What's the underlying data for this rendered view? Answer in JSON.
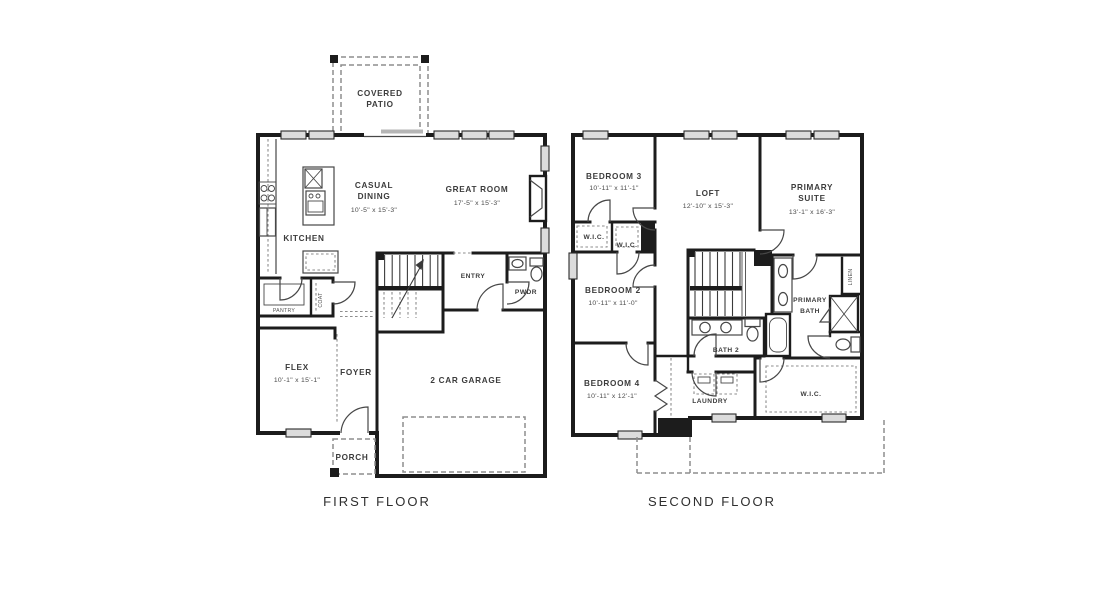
{
  "colors": {
    "wall": "#1c1c1c",
    "fixture": "#474747",
    "dash": "#8d8d8d",
    "winfill": "#dcdcdc",
    "text": "#3c3c3c",
    "bg": "#ffffff"
  },
  "floors": {
    "first": {
      "title": "FIRST FLOOR",
      "rooms": {
        "covered_patio": {
          "line1": "COVERED",
          "line2": "PATIO"
        },
        "casual_dining": {
          "line1": "CASUAL",
          "line2": "DINING",
          "dims": "10'-5\" x 15'-3\""
        },
        "great_room": {
          "name": "GREAT ROOM",
          "dims": "17'-5\" x 15'-3\""
        },
        "kitchen": {
          "name": "KITCHEN"
        },
        "pantry": {
          "name": "PANTRY"
        },
        "coat": {
          "name": "COAT"
        },
        "entry": {
          "name": "ENTRY"
        },
        "powder": {
          "name": "PWDR"
        },
        "flex": {
          "name": "FLEX",
          "dims": "10'-1\" x 15'-1\""
        },
        "foyer": {
          "name": "FOYER"
        },
        "garage": {
          "name": "2 CAR GARAGE"
        },
        "porch": {
          "name": "PORCH"
        }
      }
    },
    "second": {
      "title": "SECOND FLOOR",
      "rooms": {
        "bedroom3": {
          "name": "BEDROOM 3",
          "dims": "10'-11\" x 11'-1\""
        },
        "loft": {
          "name": "LOFT",
          "dims": "12'-10\" x 15'-3\""
        },
        "primary_suite": {
          "line1": "PRIMARY",
          "line2": "SUITE",
          "dims": "13'-1\" x 16'-3\""
        },
        "wic_bedroom3": {
          "name": "W.I.C."
        },
        "wic_bedroom2": {
          "name": "W.I.C."
        },
        "bedroom2": {
          "name": "BEDROOM 2",
          "dims": "10'-11\" x 11'-0\""
        },
        "primary_bath": {
          "line1": "PRIMARY",
          "line2": "BATH"
        },
        "linen": {
          "name": "LINEN"
        },
        "bath2": {
          "name": "BATH 2"
        },
        "bedroom4": {
          "name": "BEDROOM 4",
          "dims": "10'-11\" x 12'-1\""
        },
        "laundry": {
          "name": "LAUNDRY"
        },
        "wic_primary": {
          "name": "W.I.C."
        }
      }
    }
  }
}
